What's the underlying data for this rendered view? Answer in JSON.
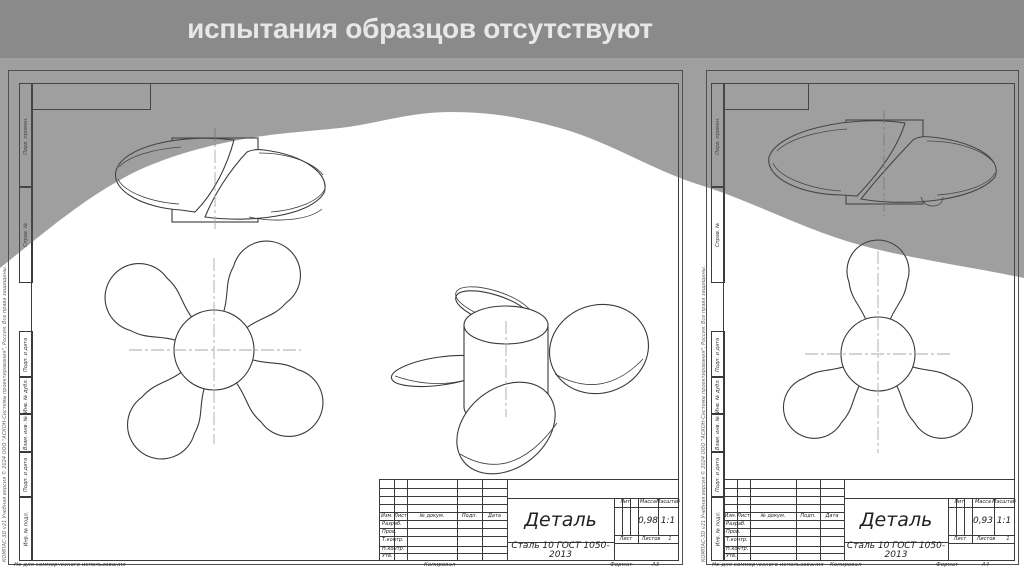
{
  "banner": {
    "text": "испытания образцов отсутствуют"
  },
  "colors": {
    "banner_bg": "#8a8a8a",
    "banner_text": "#e7e7e7",
    "overlay_fill": "rgba(80,80,80,0.55)",
    "drawing_line": "#3a3a3a",
    "centerline": "#a9a9a9",
    "sheet_bg": "#ffffff"
  },
  "sheets": [
    {
      "name": "Деталь",
      "material": "Сталь 10 ГОСТ 1050-2013",
      "mass": "0,98",
      "scale": "1:1",
      "format": "А3"
    },
    {
      "name": "Деталь",
      "material": "Сталь 10 ГОСТ 1050-2013",
      "mass": "0,93",
      "scale": "1:1",
      "format": "А4"
    }
  ],
  "titleblock": {
    "cols": {
      "izm": "Изм.",
      "list": "Лист",
      "doc": "№ докум.",
      "podp": "Подп.",
      "date": "Дата"
    },
    "rows": {
      "razrab": "Разраб.",
      "prov": "Пров.",
      "tkontr": "Т.контр.",
      "nkontr": "Н.контр.",
      "utv": "Утв."
    },
    "right": {
      "lit": "Лит.",
      "massa": "Масса",
      "masshtab": "Масштаб",
      "list": "Лист",
      "listov": "Листов",
      "listov_value": "1"
    }
  },
  "margin": {
    "perv": "Перв. примен.",
    "sprav": "Справ. №",
    "podp": "Подп. и дата",
    "inv_dubl": "Инв. № дубл.",
    "vzam": "Взам. инв. №",
    "inv_podl": "Инв. № подл."
  },
  "footer": {
    "non_commercial": "Не для коммерческого использования",
    "copied": "Копировал",
    "format_label": "Формат"
  },
  "watermark": "КОМПАС-3D v21 Учебная версия © 2024 ООО \"АСКОН-Системы проектирования\", Россия. Все права защищены."
}
